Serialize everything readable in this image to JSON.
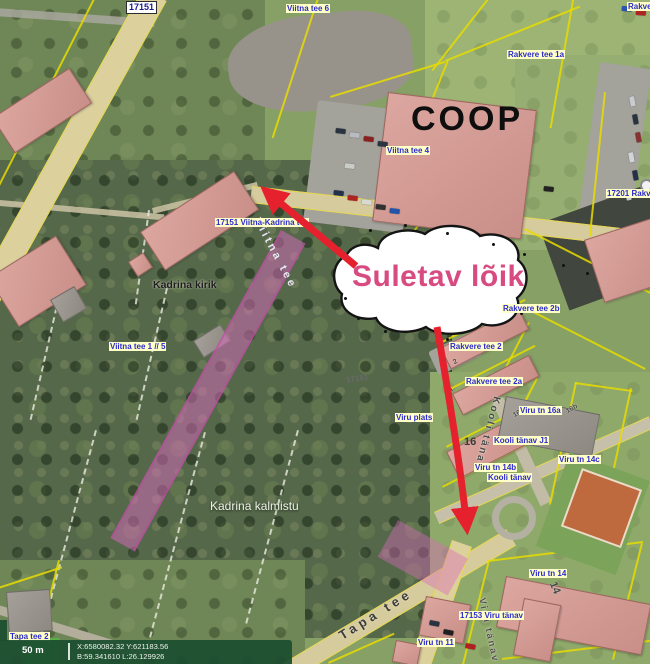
{
  "callout": {
    "text": "Suletav lõik"
  },
  "coop": "COOP",
  "road_badge": "17151",
  "labels": {
    "viitna_tee_6": "Viitna tee 6",
    "rakvere_clip": "Rakvere",
    "rakvere_tee_1a": "Rakvere tee 1a",
    "viitna_tee_4": "Viitna tee 4",
    "r17201": "17201 Rakv",
    "pohja_kadrina": "17151 Viitna-Kadrina tee",
    "kadrina_kirik": "Kadrina kirik",
    "viitna_tee_1_5": "Viitna tee 1 // 5",
    "rakvere_tee_2b": "Rakvere tee 2b",
    "rakvere_tee_2": "Rakvere tee 2",
    "rakvere_tee_2a": "Rakvere tee 2a",
    "viru_plats": "Viru plats",
    "road_17151_small": "17151",
    "viru_tn_16a": "Viru tn 16a",
    "kooli_tanav_j1": "Kooli tänav J1",
    "num_16": "16",
    "viru_tn_14c": "Viru tn 14c",
    "viru_tn_14b": "Viru tn 14b",
    "kooli_tanav": "Kooli tänav",
    "kadrina_kalmistu": "Kadrina kalmistu",
    "viru_tn_14": "Viru tn 14",
    "v17153": "17153 Viru tänav",
    "viru_tn_11": "Viru tn 11",
    "tapa_tee_2": "Tapa tee 2"
  },
  "street_names": {
    "viitna_tee": "Viitna tee",
    "kooli_tanav": "Kooli tänav",
    "tapa_tee": "Tapa tee",
    "viru_tanav": "Viru tänav"
  },
  "parcel_numbers": {
    "n2": "2",
    "n2a": "2a",
    "n16a": "16a",
    "n16b": "16b",
    "n14": "14"
  },
  "statusbar": {
    "scale": "50 m",
    "xy": "X:6580082.32 Y:621183.56",
    "bl": "B:59.341610 L:26.129926"
  },
  "colors": {
    "closure_highlight": "#db6abd",
    "arrow_red": "#e6212e",
    "callout_text": "#d84b80",
    "label_blue": "#2b2bcf",
    "label_bg": "#ffffc8",
    "statusbar_green": "#1b4d2f"
  }
}
